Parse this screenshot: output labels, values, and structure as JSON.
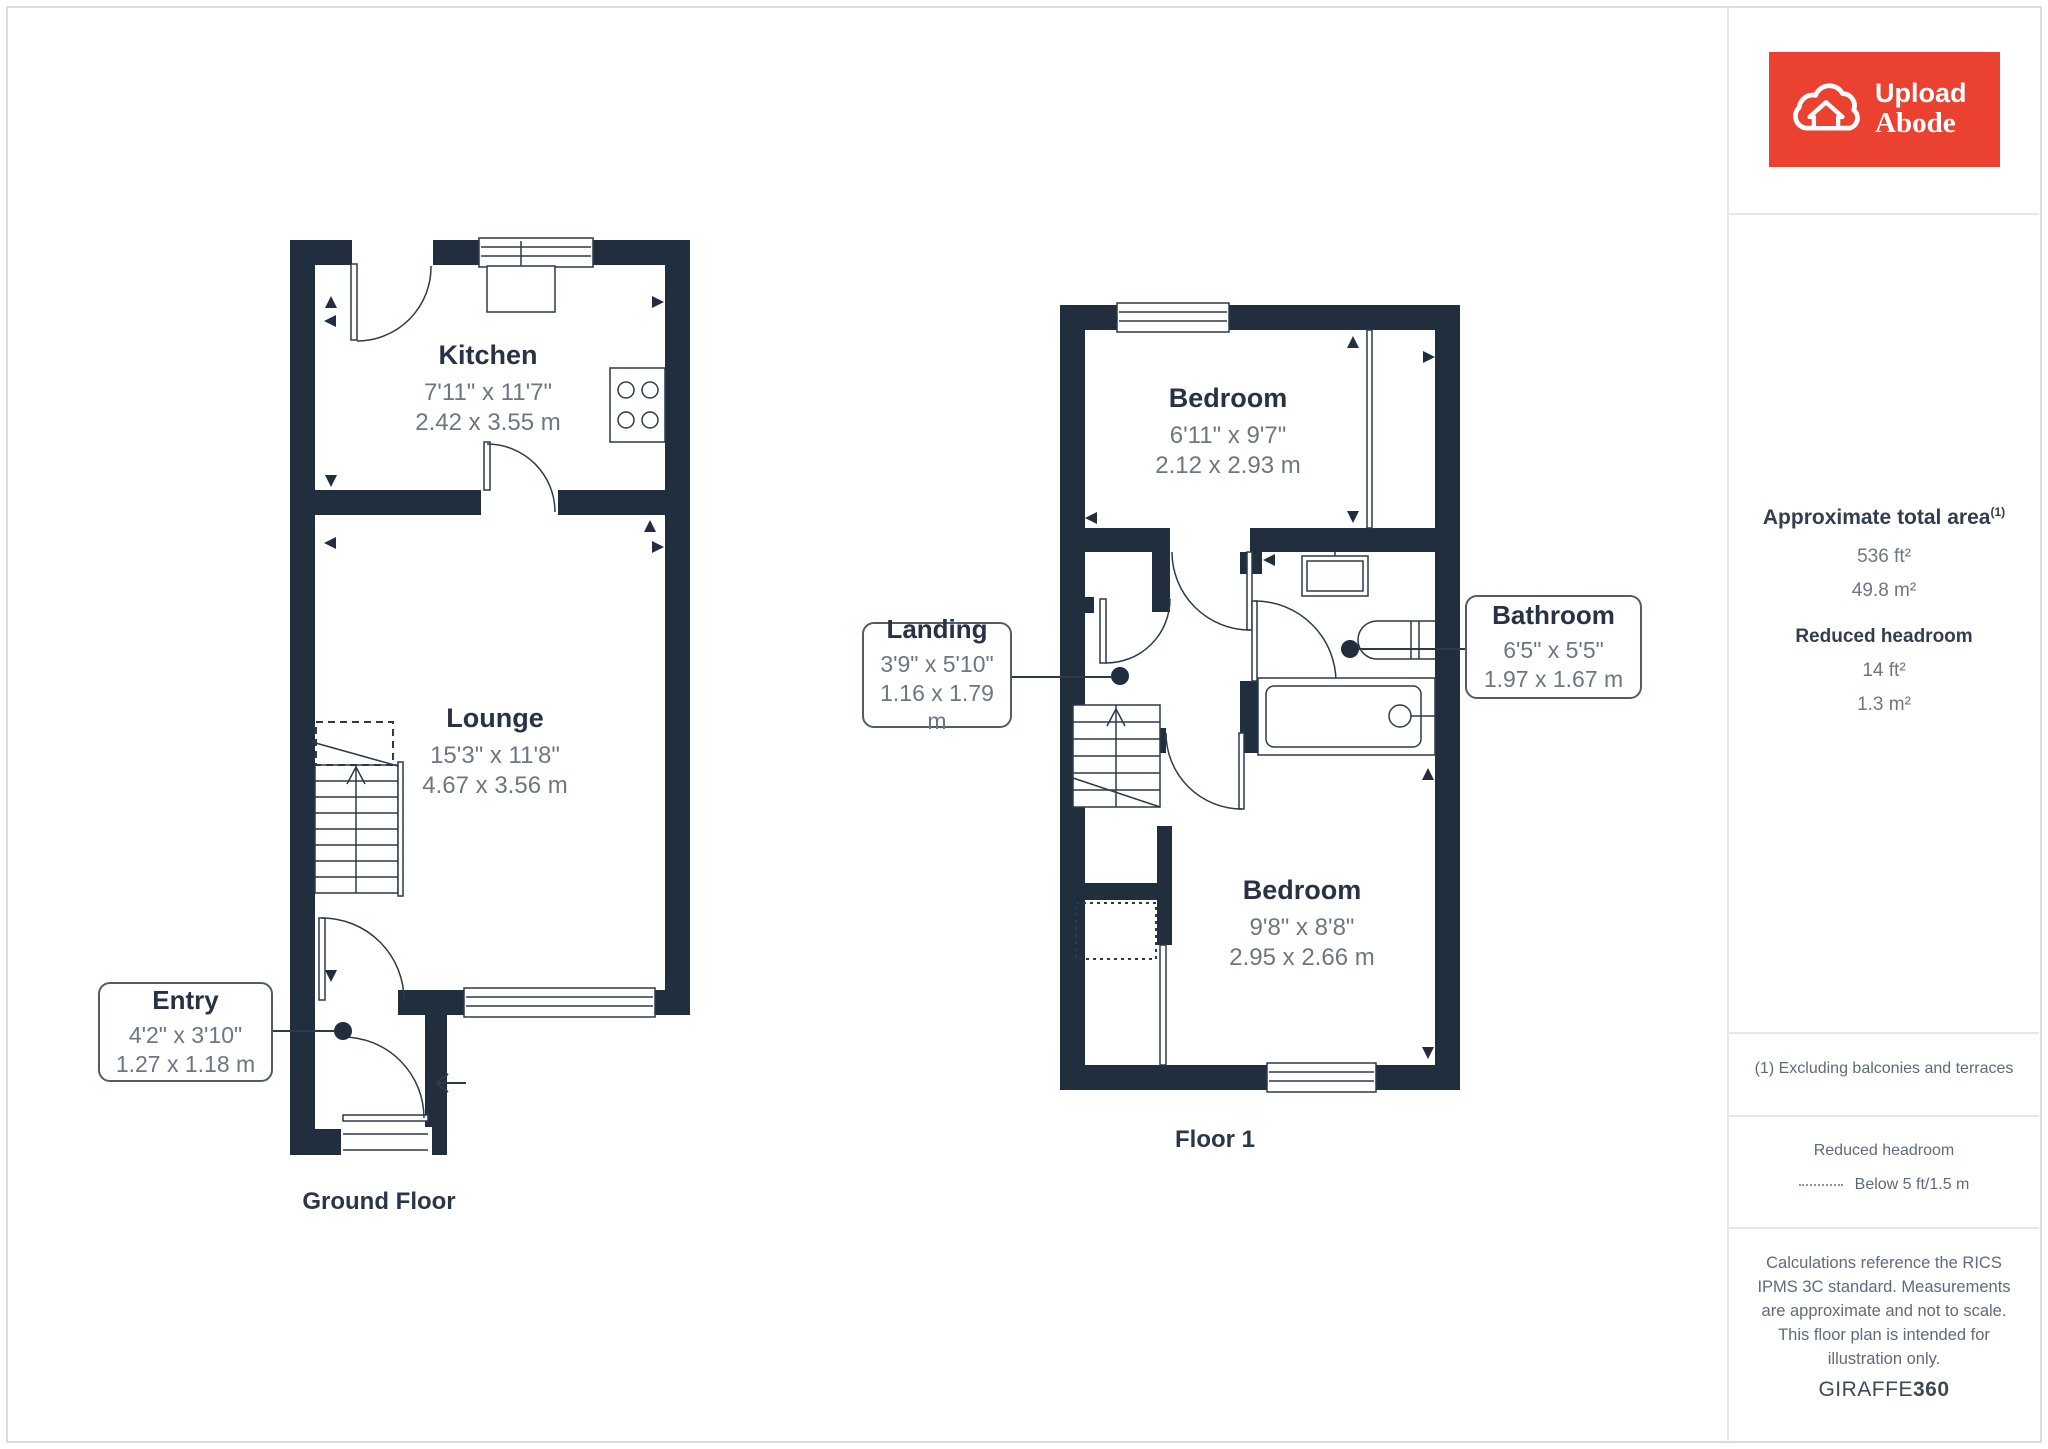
{
  "colors": {
    "wall_navy": "#202e3e",
    "brand_red": "#ea4130",
    "room_name_text": "#273244",
    "dimension_text": "#6d7683",
    "divider_gray": "#e6e7e9"
  },
  "plans": {
    "ground": {
      "caption": "Ground Floor",
      "rooms": {
        "kitchen": {
          "name": "Kitchen",
          "imperial": "7'11\" x 11'7\"",
          "metric": "2.42 x 3.55 m"
        },
        "lounge": {
          "name": "Lounge",
          "imperial": "15'3\" x 11'8\"",
          "metric": "4.67 x 3.56 m"
        },
        "entry": {
          "name": "Entry",
          "imperial": "4'2\" x 3'10\"",
          "metric": "1.27 x 1.18 m"
        }
      }
    },
    "floor1": {
      "caption": "Floor 1",
      "rooms": {
        "bedroom_top": {
          "name": "Bedroom",
          "imperial": "6'11\" x 9'7\"",
          "metric": "2.12 x 2.93 m"
        },
        "landing": {
          "name": "Landing",
          "imperial": "3'9\" x 5'10\"",
          "metric": "1.16 x 1.79 m"
        },
        "bathroom": {
          "name": "Bathroom",
          "imperial": "6'5\" x 5'5\"",
          "metric": "1.97 x 1.67 m"
        },
        "bedroom_bottom": {
          "name": "Bedroom",
          "imperial": "9'8\" x 8'8\"",
          "metric": "2.95 x 2.66 m"
        }
      }
    }
  },
  "sidebar": {
    "logo": {
      "line1": "Upload",
      "line2": "Abode"
    },
    "area": {
      "title": "Approximate total area",
      "sup": "(1)",
      "value_ft": "536 ft²",
      "value_m": "49.8 m²",
      "reduced_title": "Reduced headroom",
      "reduced_ft": "14 ft²",
      "reduced_m": "1.3 m²"
    },
    "footnote": "(1) Excluding balconies and terraces",
    "legend": {
      "title": "Reduced headroom",
      "label": "Below 5 ft/1.5 m"
    },
    "disclaimer": "Calculations reference the RICS IPMS 3C standard. Measurements are approximate and not to scale. This floor plan is intended for illustration only.",
    "brand": {
      "name": "GIRAFFE",
      "suffix": "360"
    }
  }
}
